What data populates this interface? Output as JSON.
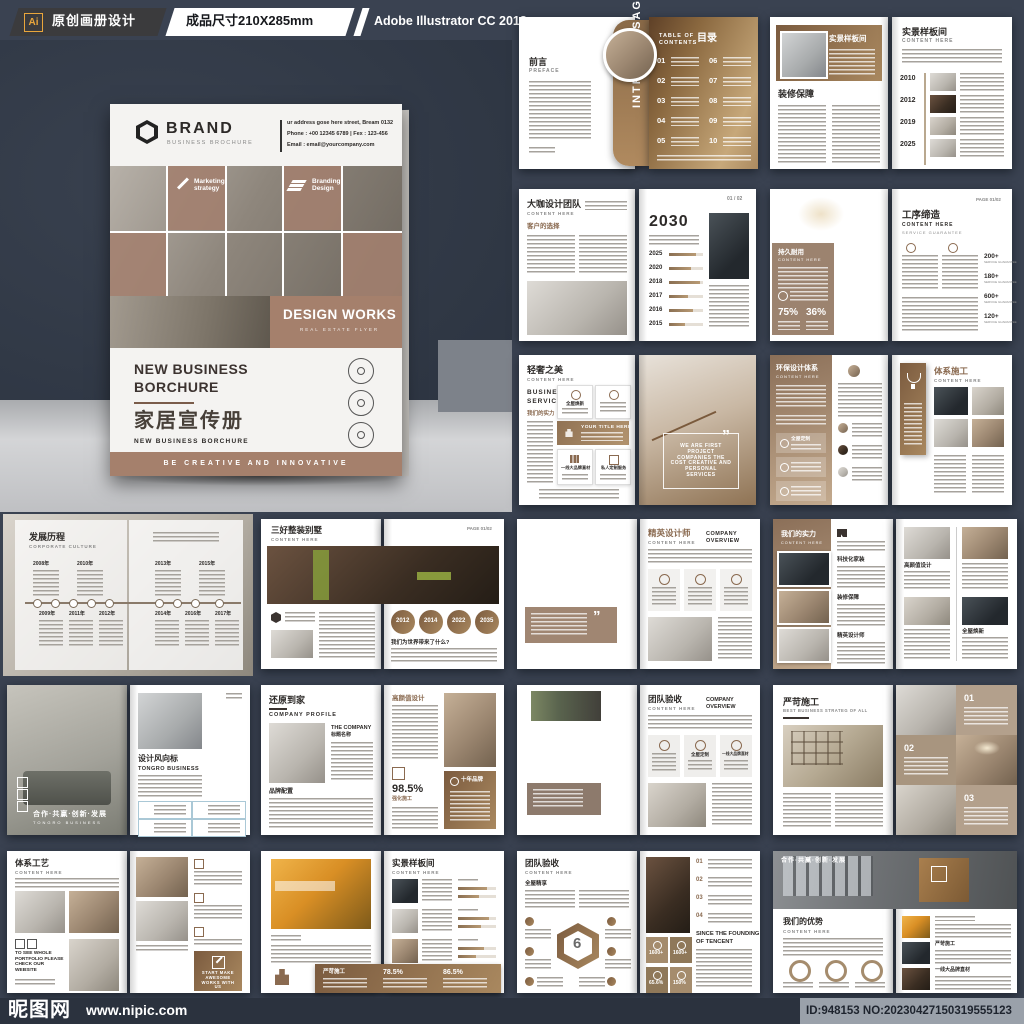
{
  "top_bar": {
    "ai_badge": "Ai",
    "label1": "原创画册设计",
    "label2": "成品尺寸210X285mm",
    "label3": "Adobe Illustrator CC 2018"
  },
  "bottom_bar": {
    "site_name": "昵图网",
    "site_url": "www.nipic.com",
    "id_text": "ID:948153 NO:20230427150319555123"
  },
  "colors": {
    "accent_brown": "#a5806c",
    "gold": "#c7a87a",
    "page_bg": "#3a4251",
    "bar_bg": "#2b323e",
    "ai_orange": "#e9a63c"
  },
  "cover": {
    "brand": "BRAND",
    "brand_sub": "BUSINESS BROCHURE",
    "address_line1": "ur address gose here street, Bream 0132",
    "address_line2": "Phone : +00 12345 6789 | Fex : 123-456",
    "address_line3": "Email   : email@yourcompany.com",
    "tile1_label": "Marketing strategy",
    "tile2_label": "Branding Design",
    "title": "DESIGN WORKS",
    "title_sub": "REAL ESTATE FLYER",
    "heading_1": "NEW BUSINESS",
    "heading_2": "BORCHURE",
    "cn_title": "家居宣传册",
    "heading_sub": "NEW BUSINESS  BORCHURE",
    "footer": "BE CREATIVE AND INNOVATIVE"
  },
  "spreads": {
    "intro": {
      "title": "前言",
      "subtitle": "PREFACE",
      "vertical": "INTRO MESSAGE",
      "toc_label_1": "TABLE OF",
      "toc_label_2": "CONTENTS",
      "toc_cn": "目录",
      "toc": [
        "01",
        "02",
        "03",
        "04",
        "05",
        "06",
        "07",
        "08",
        "09",
        "10"
      ]
    },
    "sample": {
      "banner_title": "实景样板间",
      "left_heading": "装修保障",
      "title": "实景样板间",
      "sub": "CONTENT HERE",
      "years": [
        "2010",
        "2012",
        "2019",
        "2025"
      ]
    },
    "team": {
      "title": "大咖设计团队",
      "sub": "CONTENT HERE",
      "subhead": "客户的选择",
      "big_year": "2030",
      "years": [
        "2025",
        "2020",
        "2018",
        "2017",
        "2016",
        "2015"
      ],
      "page": "01 / 02"
    },
    "process": {
      "card_title": "持久耐用",
      "card_sub": "CONTENT HERE",
      "stat1": "75%",
      "stat2": "36%",
      "title": "工序缔造",
      "sub": "CONTENT HERE",
      "tagline": "SERVICE GUARANTEE",
      "page": "PAGE 01/02",
      "stats": [
        "200+",
        "180+",
        "600+",
        "120+"
      ],
      "stat_label": "SERVICE GUARANTEE"
    },
    "luxury": {
      "title": "轻奢之美",
      "sub": "CONTENT HERE",
      "services_1": "BUSINESS",
      "services_2": "SERVICES",
      "strength": "我们的实力",
      "card1": "全屋焕新",
      "card_mid": "YOUR TITLE HERE",
      "card3": "一线大品牌直材",
      "card4": "私人定制服务",
      "quote": "WE ARE FIRST PROJECT COMPANIES THE COST CREATIVE AND PERSONAL SERVICES"
    },
    "eco": {
      "title": "环保设计体系",
      "sub": "CONTENT HERE",
      "item1": "全屋定制",
      "title2": "体系施工",
      "sub2": "CONTENT HERE"
    },
    "history": {
      "title": "发展历程",
      "sub": "CORPORATE CULTURE",
      "top_years": [
        "2008年",
        "2010年",
        "2013年",
        "2015年"
      ],
      "bottom_years": [
        "2009年",
        "2011年",
        "2012年",
        "2014年",
        "2016年",
        "2017年"
      ]
    },
    "villa": {
      "title": "三好整装别墅",
      "sub": "CONTENT HERE",
      "page": "PAGE 01/02",
      "circles": [
        "2012",
        "2014",
        "2022",
        "2035"
      ],
      "question": "我们为世界带来了什么?"
    },
    "designer": {
      "overlay_1": "ENVATO",
      "overlay_2": "MARKET CO",
      "overlay_3": "INTERNATIONAL",
      "title": "精英设计师",
      "sub": "CONTENT HERE",
      "overview_1": "COMPANY",
      "overview_2": "OVERVIEW"
    },
    "strength": {
      "title": "我们的实力",
      "sub": "CONTENT HERE",
      "item1": "科技化家装",
      "item2": "装修保障",
      "item3": "精英设计师",
      "q1": "高颜值设计",
      "q4": "全屋焕新"
    },
    "trend": {
      "title": "设计风向标",
      "sub": "TONGRO BUSINESS",
      "slogan": "合作·共赢·创新·发展",
      "slogan_sub": "TONGRO BUSINESS"
    },
    "home": {
      "title": "还原到家",
      "sub": "COMPANY PROFILE",
      "side_1": "THE COMPANY",
      "side_2": "标题名称",
      "brand_heading": "品牌配置",
      "right_heading": "高颜值设计",
      "percent": "98.5%",
      "percent_label": "强化施工",
      "card_title": "十年品牌"
    },
    "market": {
      "overlay_1": "MARKET-CO",
      "overlay_2": "INTERNATIONAL",
      "title": "团队验收",
      "sub": "CONTENT HERE",
      "overview_1": "COMPANY",
      "overview_2": "OVERVIEW",
      "card2": "全屋定制",
      "card3": "一线大品牌直材"
    },
    "strict": {
      "title": "严苛施工",
      "sub": "BEST BUSINESS STRATEG OF ALL",
      "nums": [
        "01",
        "02",
        "03"
      ]
    },
    "craft": {
      "title": "体系工艺",
      "sub": "CONTENT HERE",
      "website": "TO SEE WHOLE PORTFOLIO PLEASE CHECK OUR WEBSITE",
      "cta": "START MAKE AWESOME WORKS WITH US"
    },
    "kitchen": {
      "title": "实景样板间",
      "sub": "CONTENT HERE",
      "band_label": "严苛施工",
      "p1": "78.5%",
      "p2": "86.5%"
    },
    "hex": {
      "title": "团队验收",
      "sub": "CONTENT HERE",
      "heading": "全屋精享",
      "num": "6",
      "since_1": "SINCE THE FOUNDING",
      "since_2": "OF TENCENT",
      "stats": [
        "1600+",
        "1600+",
        "65.6%",
        "150%"
      ]
    },
    "advantage": {
      "slogan": "合作·共赢·创新·发展",
      "title": "我们的优势",
      "sub": "CONTENT HERE",
      "item2": "严苛施工",
      "item3": "一线大品牌直材"
    }
  }
}
